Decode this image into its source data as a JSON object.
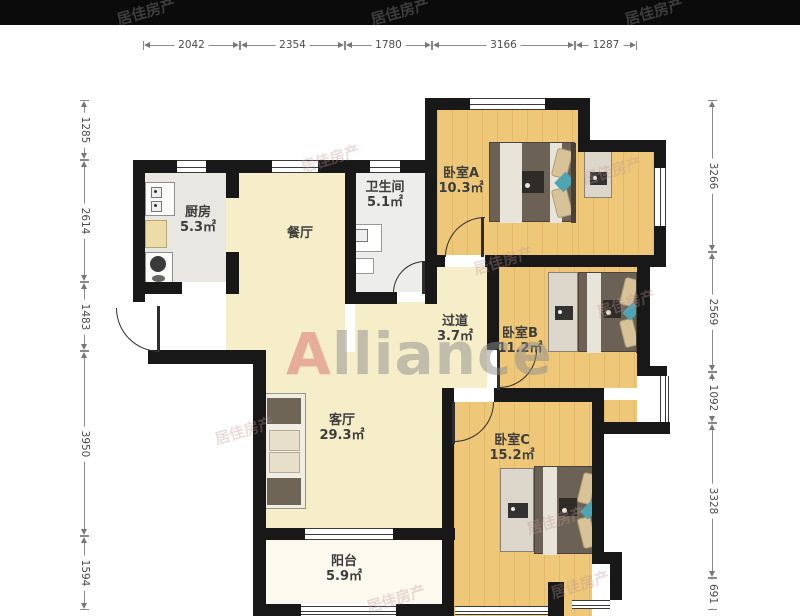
{
  "watermark": {
    "text": "居佳房产"
  },
  "logo": {
    "first": "A",
    "rest": "lliance"
  },
  "dims": {
    "top": [
      "2042",
      "2354",
      "1780",
      "3166",
      "1287"
    ],
    "left": [
      "1285",
      "2614",
      "1483",
      "3950",
      "1594"
    ],
    "right": [
      "3266",
      "2569",
      "1092",
      "3328",
      "691"
    ]
  },
  "rooms": {
    "kitchen": {
      "name": "厨房",
      "area": "5.3㎡"
    },
    "dining": {
      "name": "餐厅"
    },
    "bathroom": {
      "name": "卫生间",
      "area": "5.1㎡"
    },
    "bedroom_a": {
      "name": "卧室A",
      "area": "10.3㎡"
    },
    "hallway": {
      "name": "过道",
      "area": "3.7㎡"
    },
    "bedroom_b": {
      "name": "卧室B",
      "area": "11.2㎡"
    },
    "living": {
      "name": "客厅",
      "area": "29.3㎡"
    },
    "bedroom_c": {
      "name": "卧室C",
      "area": "15.2㎡"
    },
    "balcony": {
      "name": "阳台",
      "area": "5.9㎡"
    }
  },
  "colors": {
    "wall": "#181818",
    "wood_floor": "#eec878",
    "cream_floor": "#f6edc9",
    "accent_teal": "#4da4b2",
    "logo_red": "#d96f6f"
  }
}
